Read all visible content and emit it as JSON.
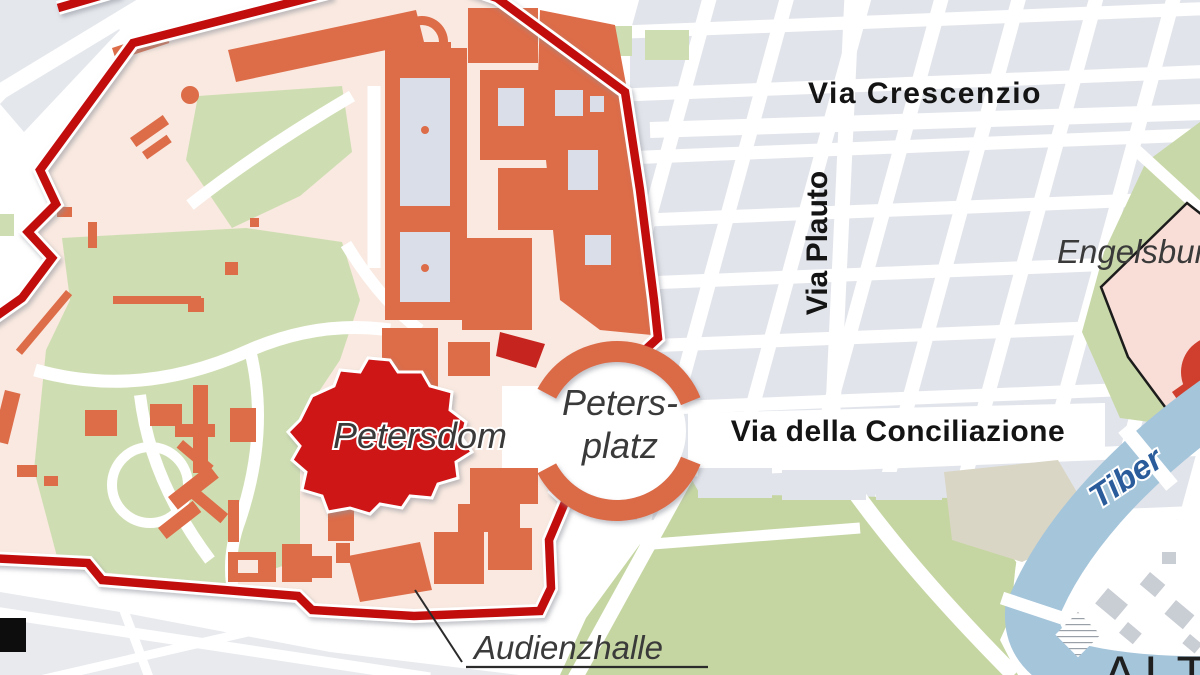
{
  "map": {
    "labels": {
      "streets": {
        "crescenzio": "Via Crescenzio",
        "plauto": "Via Plauto",
        "conciliazione": "Via della Conciliazione"
      },
      "places": {
        "petersdom": "Petersdom",
        "petersplatz_line1": "Peters-",
        "petersplatz_line2": "platz",
        "engelsburg": "Engelsburg",
        "audienzhalle": "Audienzhalle",
        "altstadt": "ALTSTADT"
      },
      "water": {
        "tiber": "Tiber"
      }
    },
    "colors": {
      "vatican_fill": "#f9e9e0",
      "boundary_red": "#c20d11",
      "building_orange": "#dd6c48",
      "basilica_red": "#cf1217",
      "garden_green": "#cfdeb2",
      "park_green": "#c5d6a2",
      "block_gray": "#e1e4ea",
      "courtyard_gray": "#d9dee8",
      "river_blue": "#a5c5db",
      "tiber_text_blue": "#2a5c9b",
      "pentagon_fill": "#f8ded7",
      "castle_red": "#d03f2e",
      "beige_block": "#dad6c5",
      "outside_gray": "#e8eaee",
      "label_dark": "#3a3a3a"
    }
  }
}
